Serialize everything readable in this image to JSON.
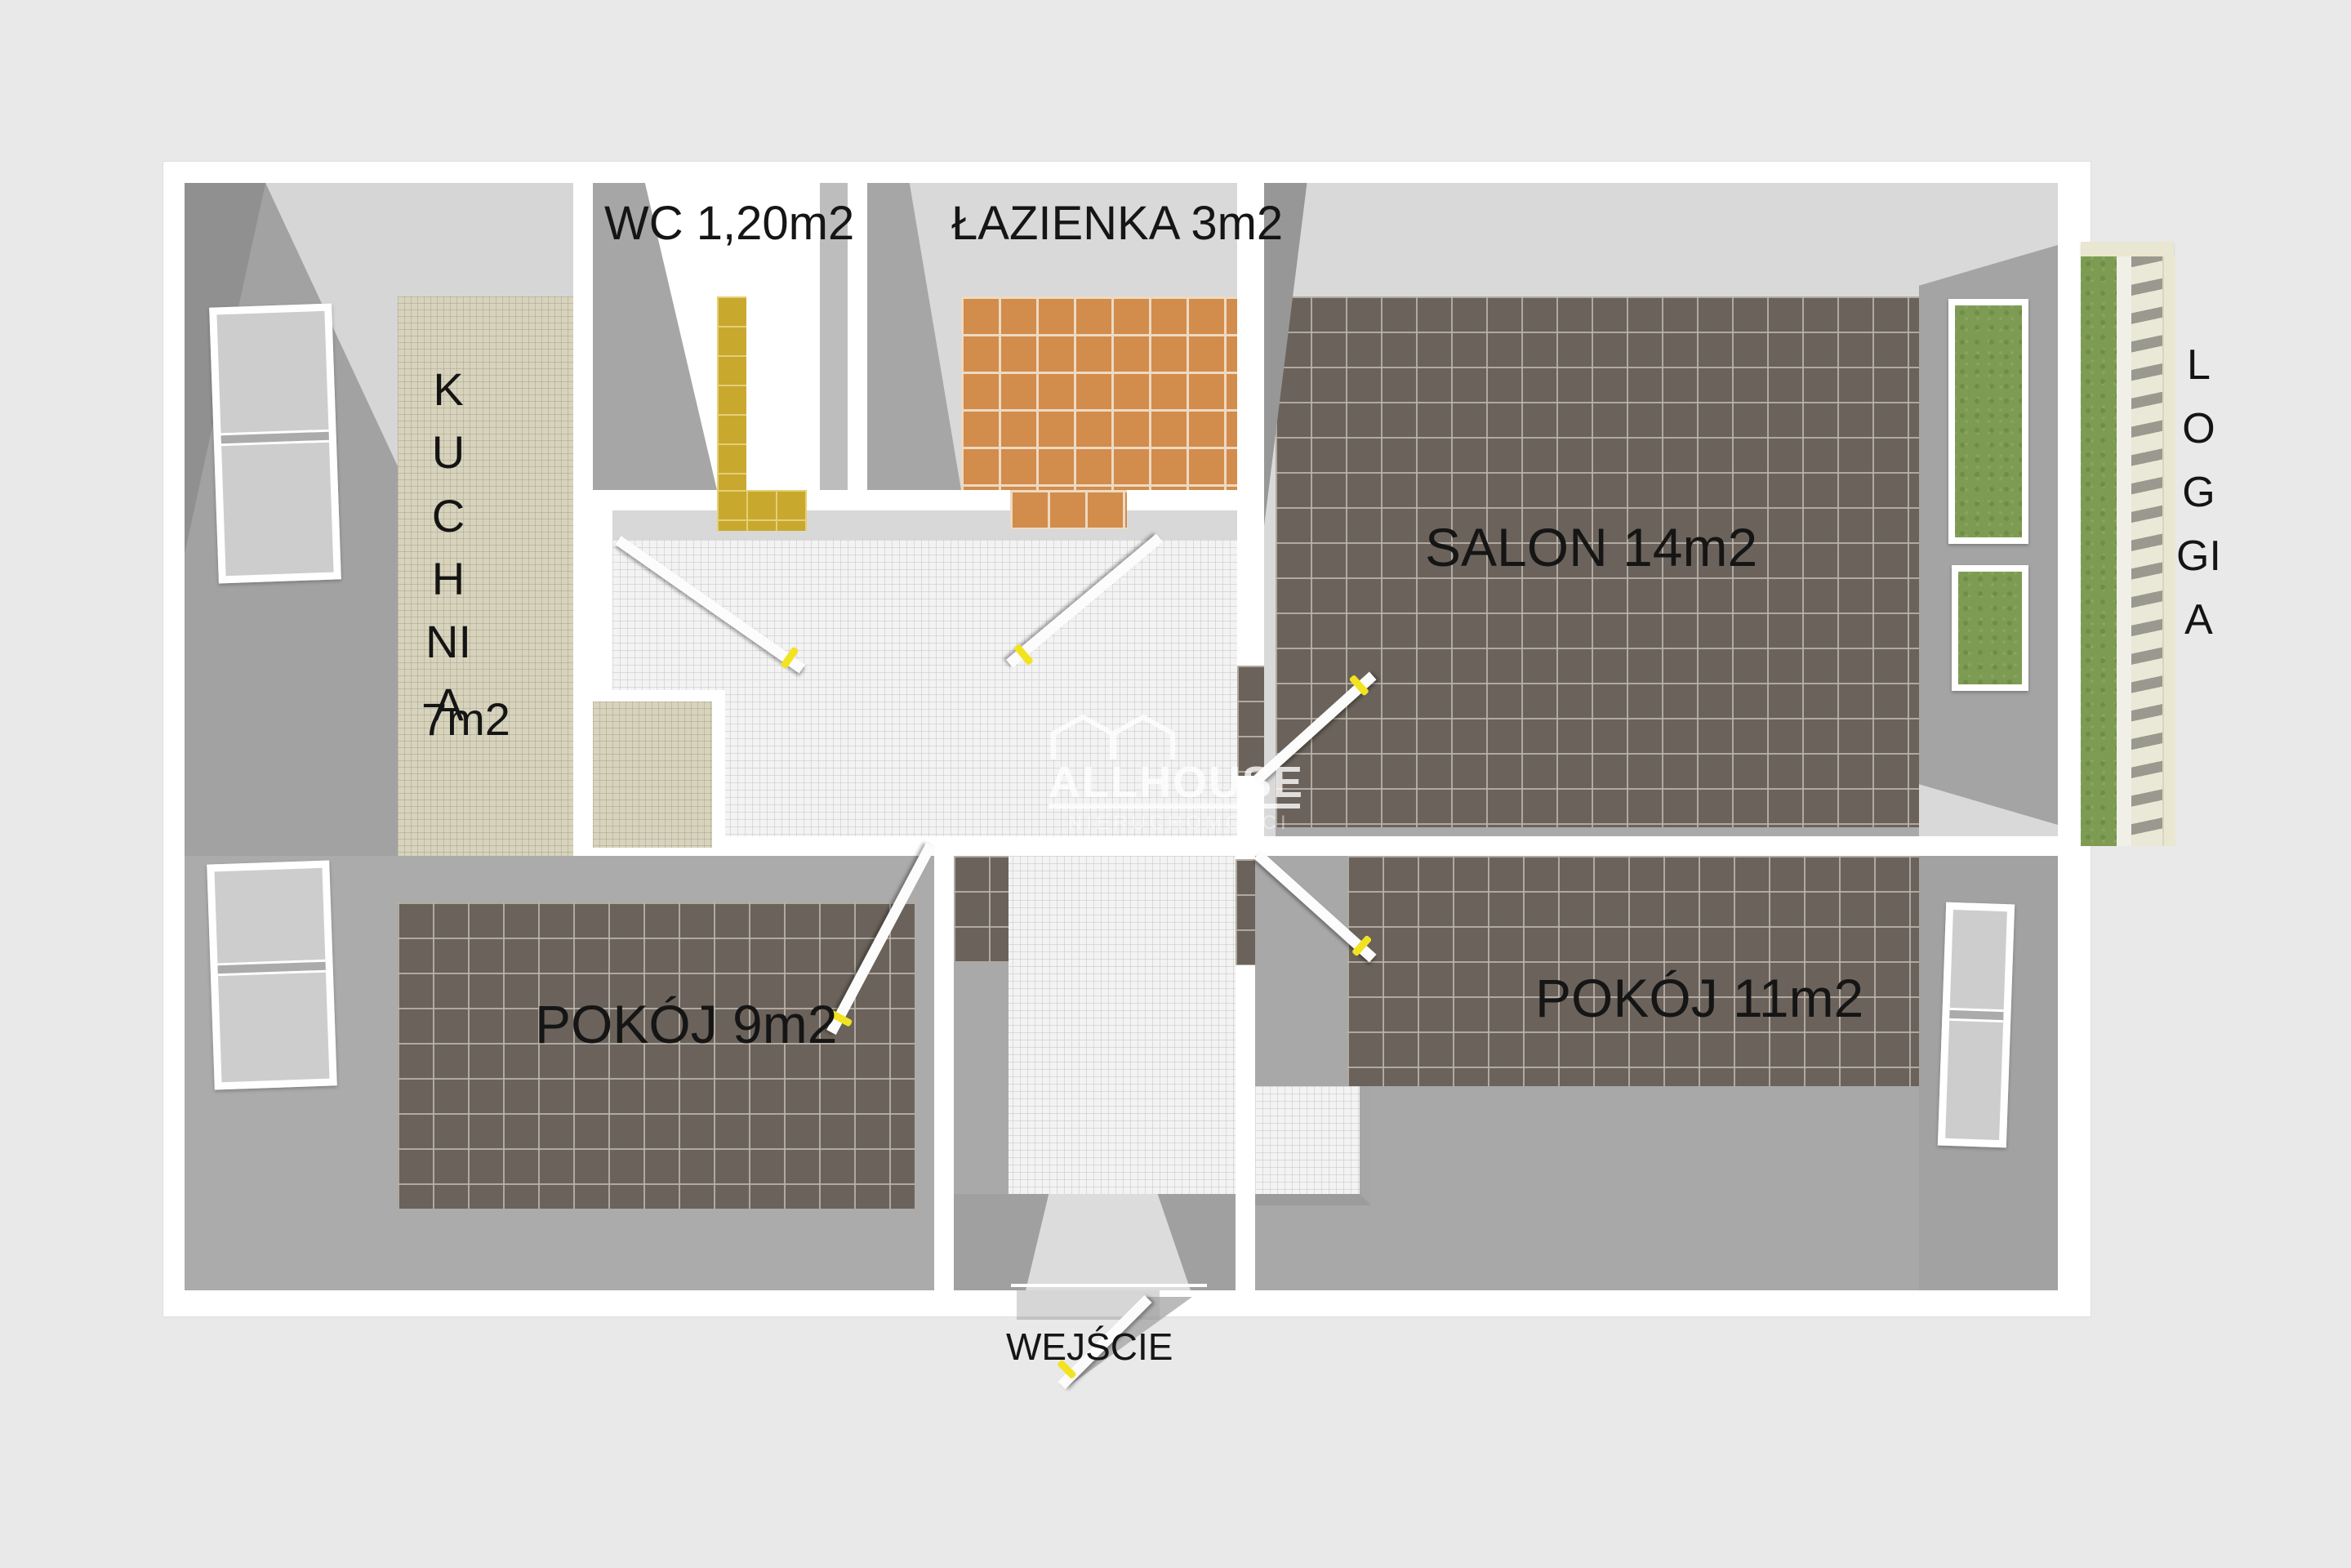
{
  "title": "Rzut mieszkania (floor plan)",
  "rooms": {
    "kuchnia": {
      "label": "KUCHNIA",
      "area": "7m2"
    },
    "wc": {
      "label": "WC 1,20m2"
    },
    "lazienka": {
      "label": "ŁAZIENKA 3m2"
    },
    "salon": {
      "label": "SALON 14m2"
    },
    "pokoj9": {
      "label": "POKÓJ 9m2"
    },
    "pokoj11": {
      "label": "POKÓJ 11m2"
    },
    "loggia": {
      "label": "LOGGIA"
    },
    "wejscie": {
      "label": "WEJŚCIE"
    }
  },
  "watermark": {
    "brand": "ALLHOUSE",
    "subtitle": "NIERUCHOMOŚCI"
  },
  "colors": {
    "background": "#e9e9e9",
    "wall_white": "#ffffff",
    "wall_gray": "#a6a6a6",
    "floor_dark_tile": "#6b635b",
    "floor_orange_tile": "#d28c4c",
    "floor_yellow_tile": "#c9a82e",
    "floor_beige_tile": "#d7d3bd",
    "floor_hall_tile": "#f3f3f3",
    "grass_green": "#7d9b52",
    "loggia_frame": "#e9e7d2",
    "door_handle_yellow": "#f2e320",
    "label_text": "#151515"
  }
}
